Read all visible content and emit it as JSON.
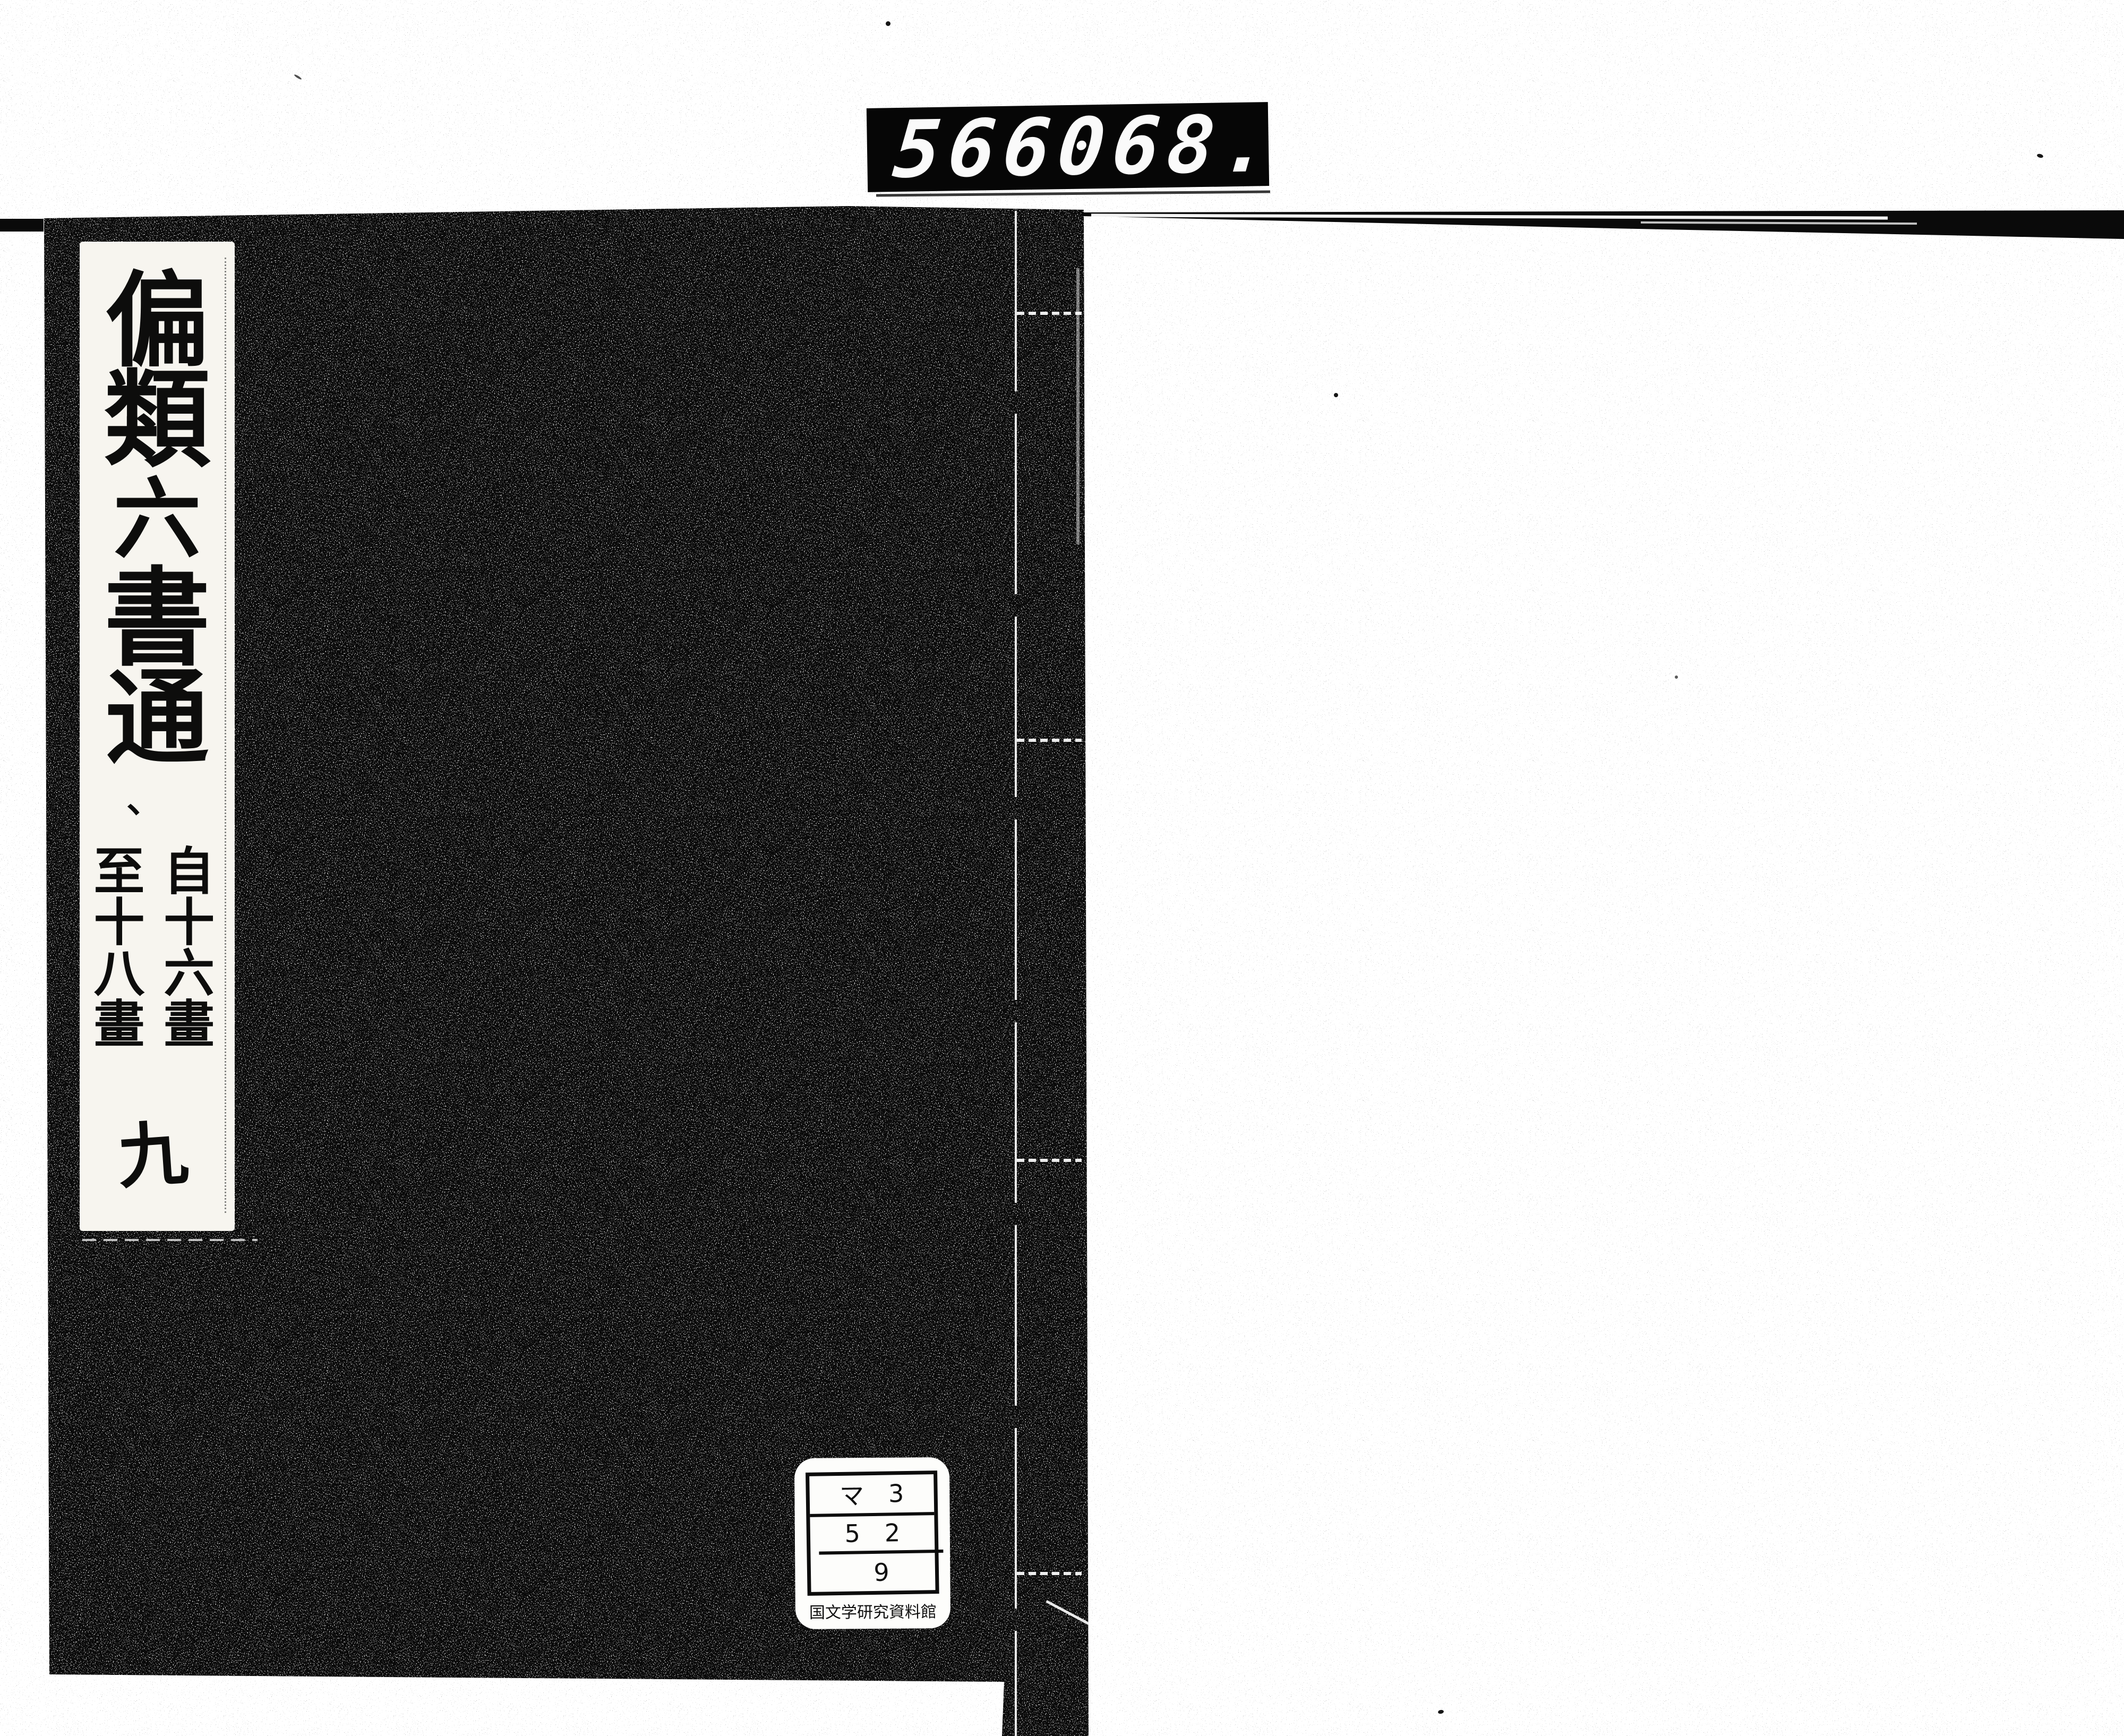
{
  "counter": {
    "left_digits": "566",
    "right_digits": "068."
  },
  "book": {
    "title_label": {
      "chars": [
        "偏",
        "類",
        "六",
        "書",
        "通"
      ],
      "punctuation_mark": "、",
      "range_start": "自十六畫",
      "range_end": "至十八畫",
      "volume": "九"
    },
    "call_number_label": {
      "rows": [
        {
          "left": "マ",
          "right": "3"
        },
        {
          "left": "5",
          "right": "2"
        },
        {
          "left": "",
          "right": "9"
        }
      ],
      "caption": "国文学研究資料館"
    }
  },
  "colors": {
    "cover_ink": "#090909",
    "paper": "#ffffff",
    "slip_paper": "#f7f5ef",
    "counter_background": "#060606",
    "counter_digits": "#fafafa"
  }
}
